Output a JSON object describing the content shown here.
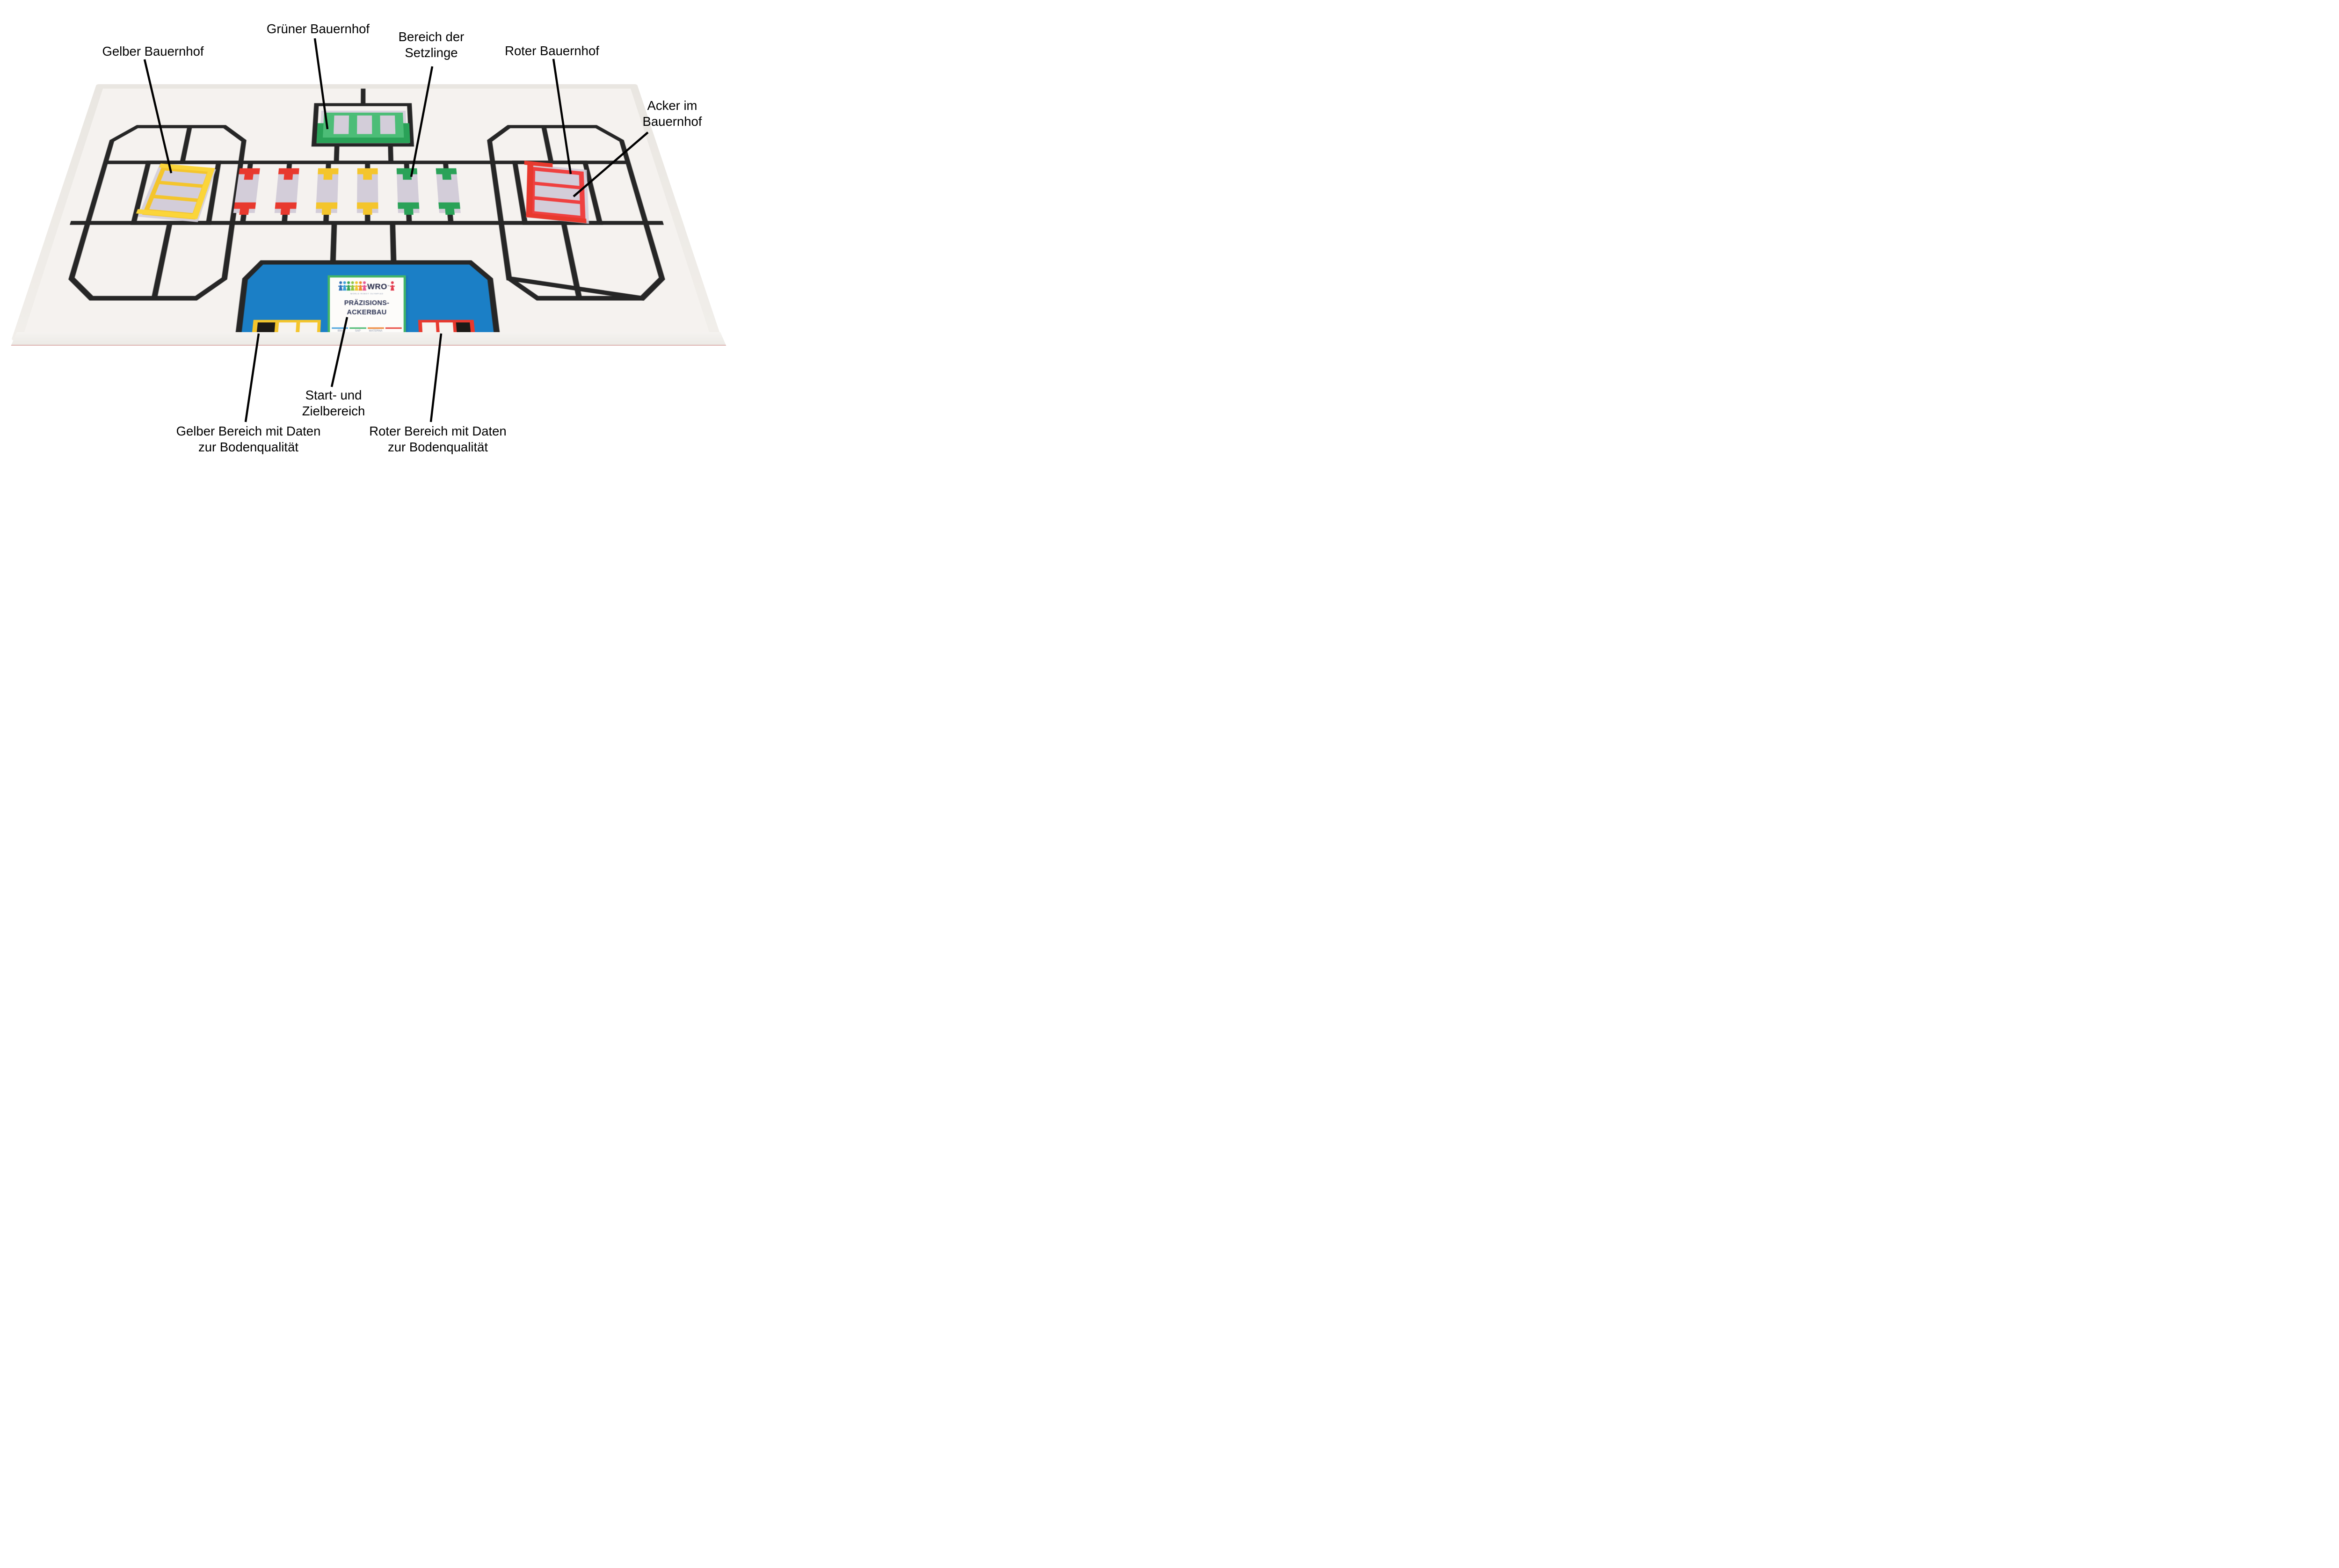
{
  "annotations": {
    "gelber_bauernhof": {
      "label": "Gelber Bauernhof"
    },
    "gruener_bauernhof": {
      "label": "Grüner Bauernhof"
    },
    "bereich_setzlinge": {
      "line1": "Bereich der",
      "line2": "Setzlinge"
    },
    "roter_bauernhof": {
      "label": "Roter Bauernhof"
    },
    "acker_im_bauernhof": {
      "line1": "Acker im",
      "line2": "Bauernhof"
    },
    "start_ziel": {
      "line1": "Start- und",
      "line2": "Zielbereich"
    },
    "gelber_bereich": {
      "line1": "Gelber Bereich mit Daten",
      "line2": "zur Bodenqualität"
    },
    "roter_bereich": {
      "line1": "Roter Bereich mit Daten",
      "line2": "zur Bodenqualität"
    }
  },
  "sign": {
    "logo_text": "WRO",
    "logo_tm": "™",
    "logo_subtitle": "WORLD ROBOT OLYMPIAD",
    "title_line1": "PRÄZISIONS-",
    "title_line2": "ACKERBAU",
    "sponsors": [
      "IBM",
      "SAP",
      "MATERNA",
      ""
    ]
  },
  "field": {
    "colors": {
      "tray": "#efece7",
      "mat": "#f5f2ef",
      "line": "#262626",
      "blue": "#1b7fc6",
      "yellow": "#f4c52c",
      "yellow_bright": "#fbd53a",
      "red": "#ef4040",
      "red_bright": "#e8392e",
      "green": "#4cbd77",
      "green_dark": "#2aa258",
      "patch": "#d3cdd9",
      "black_block": "#1d1a17",
      "white_block": "#f6f3ef"
    },
    "seedlings": [
      "red",
      "red",
      "yellow",
      "yellow",
      "green",
      "green"
    ],
    "yellow_area_blocks": [
      "black",
      "white",
      "white"
    ],
    "red_area_blocks": [
      "white",
      "white",
      "black"
    ]
  }
}
